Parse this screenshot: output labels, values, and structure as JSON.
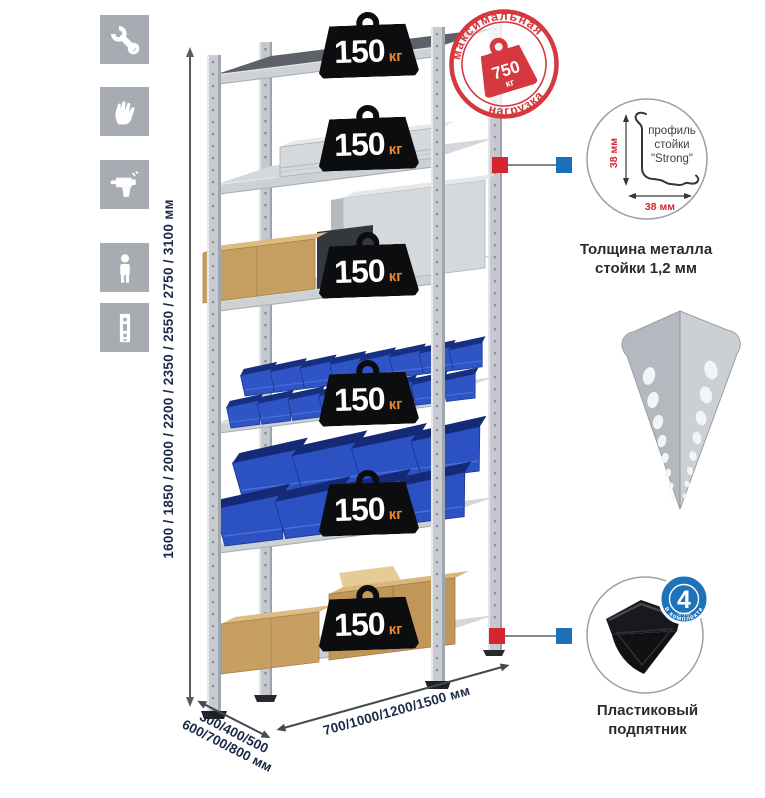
{
  "palette": {
    "accent_red": "#d5252f",
    "accent_blue": "#1c70b8",
    "bin_blue": "#2e54c5",
    "icon_gray": "#a7acb3",
    "steel_gray": "#c9cdd2",
    "navy_text": "#1b2a47",
    "weight_black": "#0c0d0e",
    "unit_orange": "#ee872b"
  },
  "sidebar_icons": [
    "wrench",
    "gloves",
    "drill",
    "person",
    "rack-post"
  ],
  "height_dimension": {
    "label": "1600 / 1850 / 2000 / 2200 / 2350 / 2550 / 2750 / 3100 мм"
  },
  "depth_dimension": {
    "line1": "300/400/500",
    "line2": "600/700/800 мм"
  },
  "width_dimension": {
    "label": "700/1000/1200/1500 мм"
  },
  "shelf_load": {
    "value": "150",
    "unit": "кг",
    "count": 6
  },
  "max_load_stamp": {
    "top_arc": "максимальная",
    "bottom_arc": "нагрузка",
    "value": "750",
    "unit": "кг"
  },
  "post_profile": {
    "text_line1": "профиль",
    "text_line2": "стойки",
    "text_line3": "\"Strong\"",
    "vertical_dim": "38 мм",
    "horizontal_dim": "38 мм",
    "caption_line1": "Толщина металла",
    "caption_line2": "стойки 1,2 мм"
  },
  "foot": {
    "badge_count": "4",
    "badge_unit": "штуки",
    "badge_arc": "в комплекте",
    "caption_line1": "Пластиковый",
    "caption_line2": "подпятник"
  }
}
